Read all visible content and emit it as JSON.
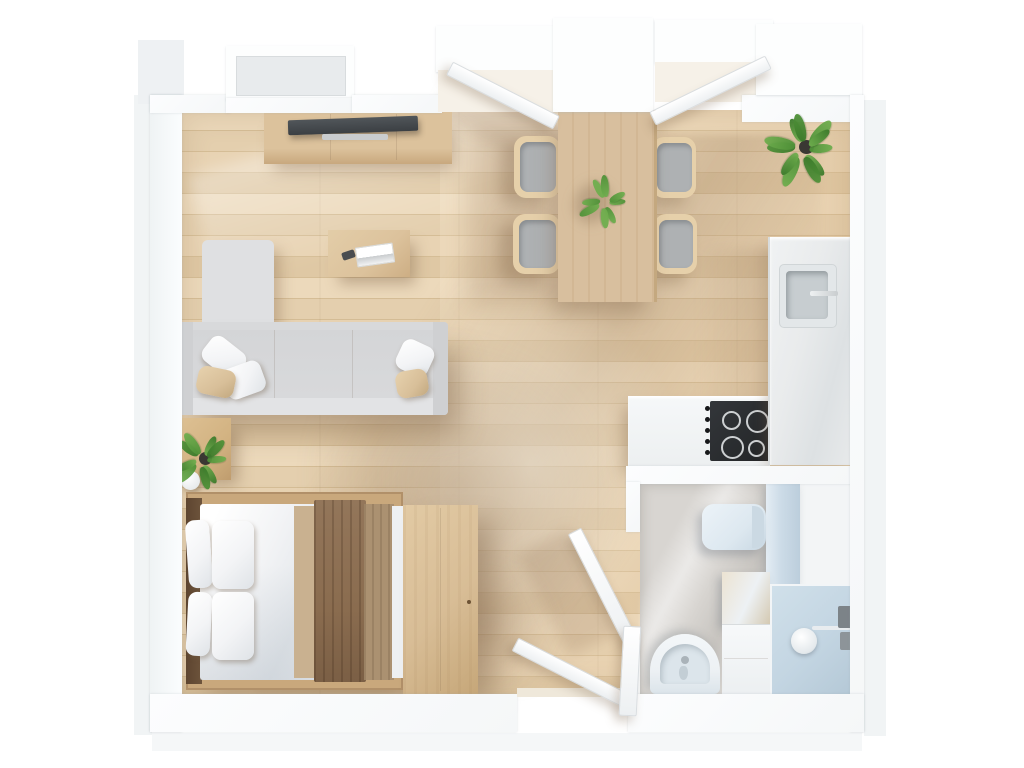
{
  "meta": {
    "scene_type": "floor-plan-top-view-3d-render",
    "description": "Photorealistic top-down 3D render of a studio apartment floor plan on a white background. No text labels are rendered in the image.",
    "canvas": {
      "width": 1024,
      "height": 768
    }
  },
  "rooms": [
    {
      "id": "living-area",
      "items": [
        {
          "name": "tv-console"
        },
        {
          "name": "tv"
        },
        {
          "name": "soundbar"
        },
        {
          "name": "coffee-table"
        },
        {
          "name": "book"
        },
        {
          "name": "remote"
        },
        {
          "name": "corner-sofa"
        },
        {
          "name": "throw-pillow-white",
          "count": 3
        },
        {
          "name": "throw-pillow-tan",
          "count": 2
        },
        {
          "name": "side-table"
        },
        {
          "name": "sphere-lamp"
        },
        {
          "name": "potted-plant"
        }
      ]
    },
    {
      "id": "dining-area",
      "items": [
        {
          "name": "dining-table"
        },
        {
          "name": "dining-chair",
          "count": 4
        },
        {
          "name": "table-plant"
        }
      ]
    },
    {
      "id": "kitchen",
      "items": [
        {
          "name": "tall-counter-fridge-unit"
        },
        {
          "name": "kitchen-sink"
        },
        {
          "name": "faucet"
        },
        {
          "name": "base-cabinet"
        },
        {
          "name": "cooktop"
        },
        {
          "name": "burner",
          "count": 4
        },
        {
          "name": "knob",
          "count": 5
        }
      ]
    },
    {
      "id": "sleeping-area",
      "items": [
        {
          "name": "double-bed"
        },
        {
          "name": "bed-pillow",
          "count": 4
        },
        {
          "name": "duvet"
        },
        {
          "name": "throw-blanket-dark"
        },
        {
          "name": "throw-blanket-light"
        },
        {
          "name": "wardrobe"
        }
      ]
    },
    {
      "id": "bathroom",
      "items": [
        {
          "name": "toilet"
        },
        {
          "name": "wash-basin"
        },
        {
          "name": "vanity-cabinet"
        },
        {
          "name": "shower"
        },
        {
          "name": "shower-drain"
        },
        {
          "name": "shower-fixture"
        },
        {
          "name": "storage-panel"
        }
      ]
    },
    {
      "id": "entry",
      "items": [
        {
          "name": "entry-door-leaf",
          "count": 2
        },
        {
          "name": "bathroom-door-leaf"
        }
      ]
    },
    {
      "id": "corner",
      "items": [
        {
          "name": "corner-plant"
        }
      ]
    }
  ],
  "openings": [
    {
      "name": "window-bay-top-left"
    },
    {
      "name": "balcony-door-bay-left",
      "state": "open"
    },
    {
      "name": "balcony-door-bay-right",
      "state": "open"
    },
    {
      "name": "entry-opening-bottom",
      "state": "open"
    },
    {
      "name": "bathroom-doorway",
      "state": "open"
    }
  ],
  "palette": {
    "exterior_shadow": "#eef1f3",
    "wall": "#f5f7f8",
    "wall_edge": "#e3e7e9",
    "floor_a": "#ecd9bb",
    "floor_b": "#e4cfae",
    "floor_c": "#e8d3b3",
    "floor_d": "#dfc8a4",
    "floor_seam": "#d5bd96",
    "sofa_base": "#d8d9db",
    "sofa_light": "#e2e3e5",
    "sofa_arm": "#cfd0d2",
    "sofa_chaise": "#dfe0e2",
    "pillow_white": "#f3f4f6",
    "pillow_tan": "#d8bf99",
    "wood_console": "#dcc29c",
    "wood_edge": "#c8a87e",
    "wood_table": "#d8bf9e",
    "wood_wardrobe": "#d8bd96",
    "wood_nightstand": "#d2b281",
    "wood_bedframe": "#c9a87c",
    "tv": "#3b3f43",
    "tv_stand": "#c9ccce",
    "chair_wood": "#e6d0aa",
    "chair_cushion": "#aeb1b3",
    "bed_headboard": "#6e543c",
    "duvet": "#f2f3f5",
    "blanket_dark": "#8a6c4f",
    "blanket_mid": "#ab9171",
    "blanket_under": "#c9b190",
    "marble": "#e9ebec",
    "marble_edge": "#d8dcdd",
    "sink_outer": "#e3e7e9",
    "sink_inner": "#c7cdd0",
    "cooktop": "#232527",
    "burner_ring": "#cdd0d2",
    "bath_floor": "#d8d5d1",
    "bath_blue": "#ccdbe7",
    "shower_floor": "#c3d5e2",
    "fixture_blue": "#dde8f0",
    "porcelain": "#edf1f4",
    "plant_green": "#4f9138",
    "plant_light": "#6fae4e",
    "plant_dark": "#3c7a2b",
    "pot": "#3a3833",
    "door_edge": "#d9dde0"
  }
}
